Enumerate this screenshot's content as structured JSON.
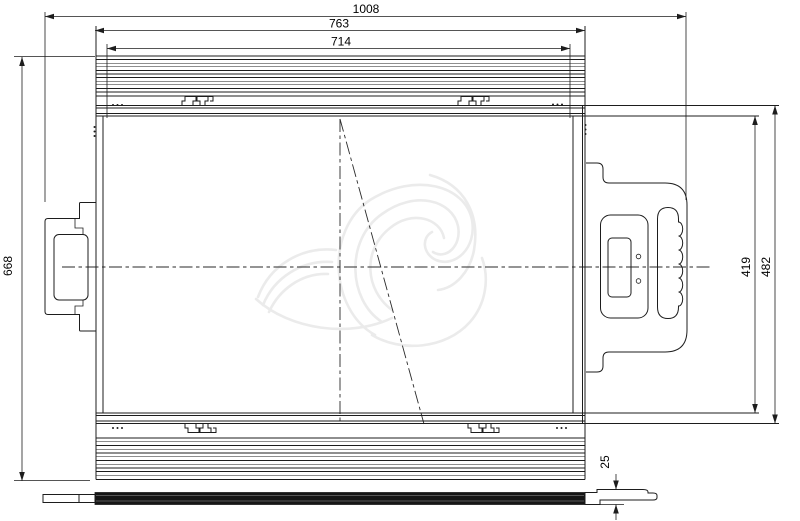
{
  "drawing": {
    "type": "2D engineering dimension drawing, side elevation of finned enclosure with connector, carry handle and base plate",
    "dims": {
      "overall_width": "1008",
      "outer_width": "763",
      "fin_width": "714",
      "overall_height": "668",
      "inner_height": "419",
      "flange_height": "482",
      "plate_thickness": "25"
    },
    "colors": {
      "line": "#1d1d1d",
      "dim_text": "#000000",
      "watermark": "#ebebeb",
      "background": "#ffffff"
    }
  }
}
